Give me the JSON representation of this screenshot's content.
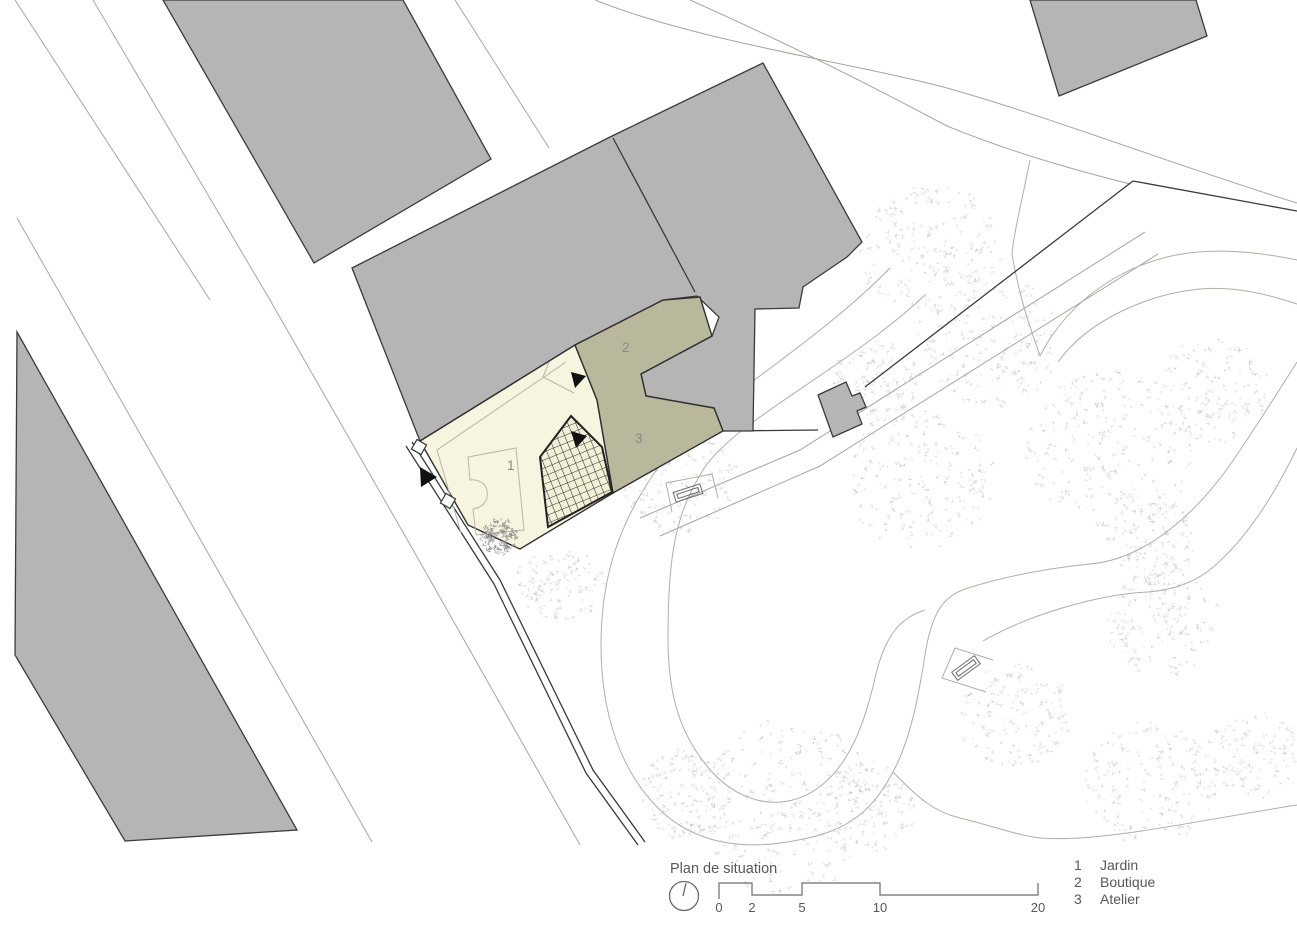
{
  "title": "Plan de situation",
  "scalebar": {
    "ticks": [
      {
        "label": "0"
      },
      {
        "label": "2"
      },
      {
        "label": "5"
      },
      {
        "label": "10"
      },
      {
        "label": "20"
      }
    ]
  },
  "legend": {
    "items": [
      {
        "num": "1",
        "label": "Jardin"
      },
      {
        "num": "2",
        "label": "Boutique"
      },
      {
        "num": "3",
        "label": "Atelier"
      }
    ]
  },
  "plan": {
    "area_labels": [
      {
        "num": "1"
      },
      {
        "num": "2"
      },
      {
        "num": "3"
      }
    ],
    "colors": {
      "building_fill": "#b5b5b5",
      "building_outline": "#3b3b3b",
      "garden_fill": "#f7f4df",
      "shop_fill": "#b9b79c",
      "hatch_line": "#2e2e2e",
      "road_line": "#a9a49e",
      "path_line": "#b2ada6",
      "boundary_line": "#3a3a3a",
      "legend_text": "#58585a",
      "plan_label_text": "#8a8a8a",
      "tree_mark_light": "#c6c6c6",
      "tree_mark_dark": "#aeaeae",
      "garden_tree_mark": "#949494"
    },
    "tree_clusters": [
      [
        930,
        250,
        70
      ],
      [
        990,
        340,
        72
      ],
      [
        878,
        382,
        45
      ],
      [
        1110,
        450,
        85
      ],
      [
        1210,
        390,
        58
      ],
      [
        1152,
        540,
        45
      ],
      [
        920,
        480,
        75
      ],
      [
        680,
        480,
        56
      ],
      [
        560,
        582,
        42
      ],
      [
        785,
        805,
        95
      ],
      [
        690,
        795,
        48
      ],
      [
        865,
        808,
        50
      ],
      [
        1015,
        715,
        56
      ],
      [
        1150,
        782,
        66
      ],
      [
        1162,
        622,
        56
      ],
      [
        1255,
        755,
        46
      ]
    ],
    "garden_tree": [
      500,
      536,
      18
    ]
  }
}
